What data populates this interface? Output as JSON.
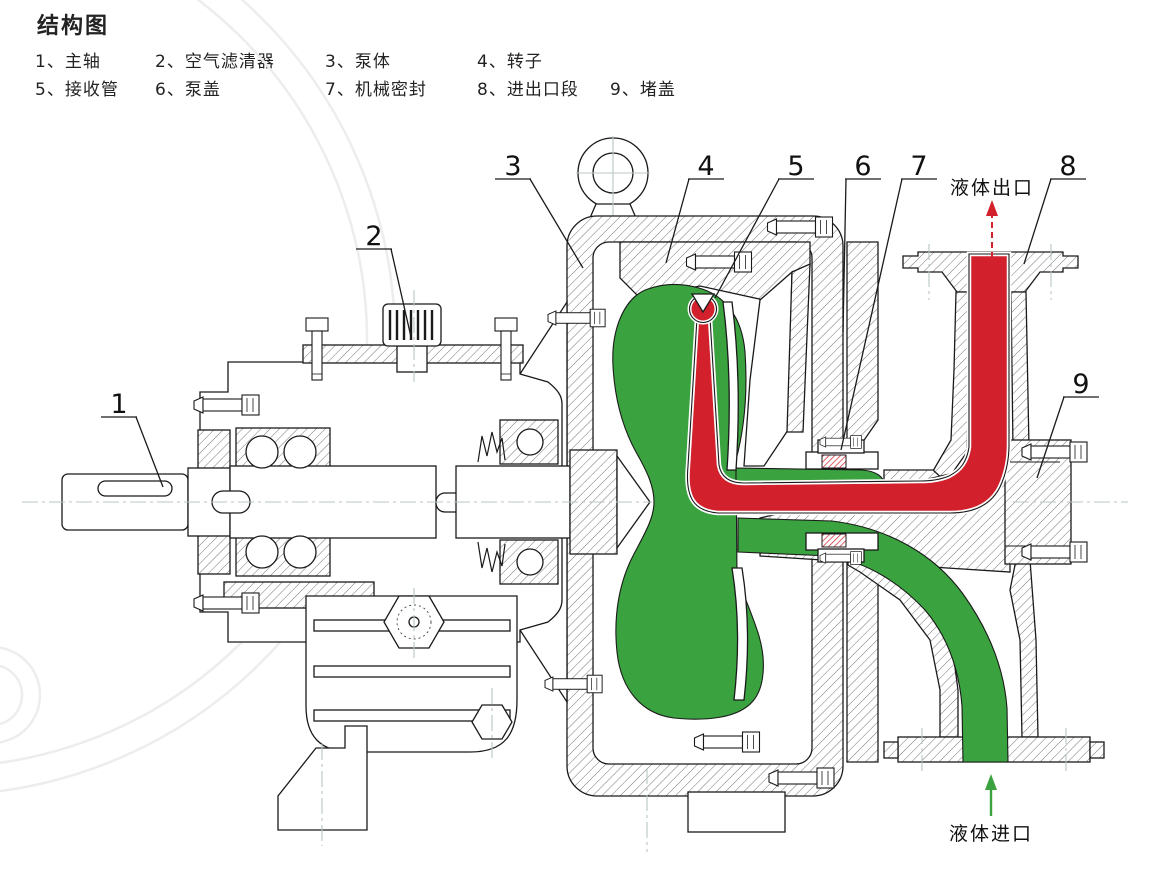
{
  "title": "结构图",
  "legend": {
    "rows": [
      [
        "1、主轴",
        "2、空气滤清器",
        "3、泵体",
        "4、转子"
      ],
      [
        "5、接收管",
        "6、泵盖",
        "7、机械密封",
        "8、进出口段",
        "9、堵盖"
      ]
    ]
  },
  "callouts": [
    "1",
    "2",
    "3",
    "4",
    "5",
    "6",
    "7",
    "8",
    "9"
  ],
  "flow": {
    "outlet_label": "液体出口",
    "inlet_label": "液体进口"
  },
  "colors": {
    "flow_red": "#d2202c",
    "flow_green": "#3aa23e",
    "line": "#1a1a1a",
    "centerline": "#b9c7c0",
    "hatch": "#777777",
    "watermark": "#ededed",
    "text": "#232323"
  }
}
